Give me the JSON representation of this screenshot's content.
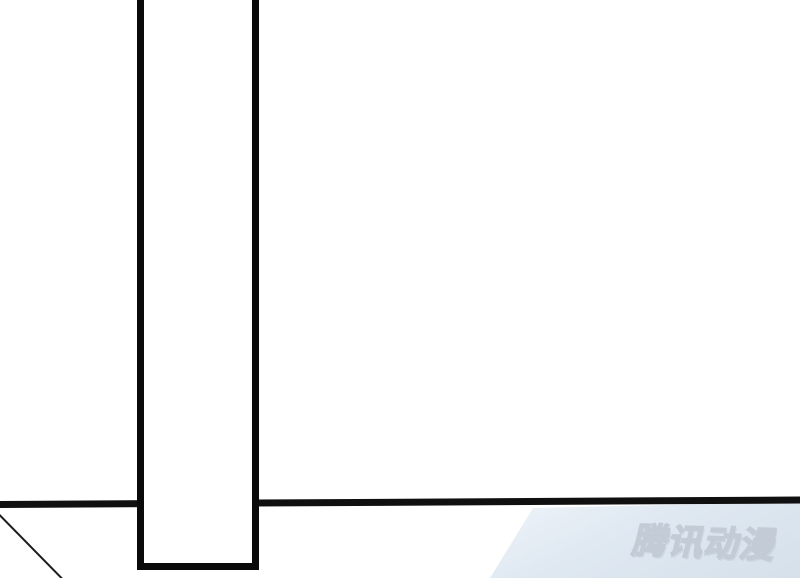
{
  "page": {
    "width": 800,
    "height": 578,
    "background": "#ffffff",
    "description_text": ""
  },
  "panel": {
    "gutter_fill": "#ffffff",
    "border_color": "#0a0a0a",
    "line_color": "#101010",
    "sketch_line_color": "#1c1c1c"
  },
  "corner_shade": {
    "color_top": "#eff4f9",
    "color_bottom": "#d5e0ea"
  },
  "watermark": {
    "text": "腾讯动漫",
    "color": "#c3cbd6"
  }
}
